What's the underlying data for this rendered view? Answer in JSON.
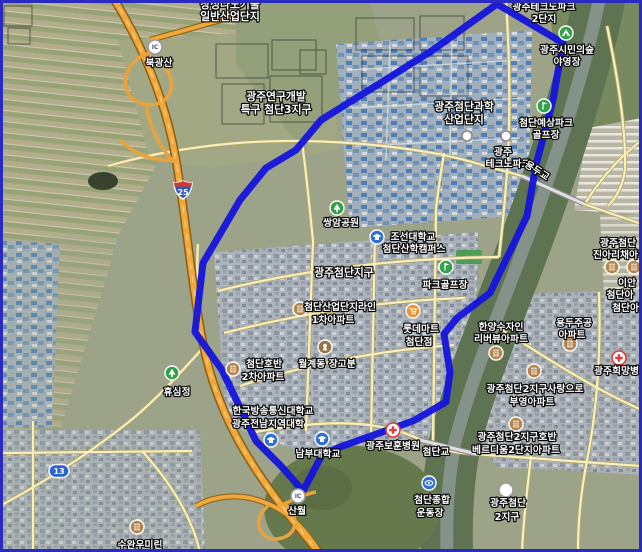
{
  "map": {
    "type": "satellite-map-with-district-boundary",
    "colors": {
      "boundary": "#1414dd",
      "frame": "#2a2ac0",
      "expressway": "#f0a73c",
      "minor_road": "#f6efc6",
      "river": "#5d7351",
      "marker_green": "#33a04a",
      "marker_blue": "#2f6fd6",
      "marker_brown": "#b5854e",
      "marker_orange": "#f09433",
      "hospital_red": "#e23b3b"
    },
    "labels": {
      "nano1": "장성나노기술",
      "nano2": "일반산업단지",
      "rnd1": "광주연구개발",
      "rnd2": "특구 첨단3지구",
      "ic_badge": "IC",
      "ic_bukgwangsan": "북광산",
      "route25": "25",
      "route13": "13",
      "tp1": "광주테크노파크",
      "tp2": "2단지",
      "forest1": "광주시민의숲",
      "forest2": "야영장",
      "sci1": "광주첨단과학",
      "sci2": "산업단지",
      "pgolf_n1": "첨단예상파크",
      "pgolf_n2": "골프장",
      "gtp1": "광주",
      "gtp2": "테크노파크",
      "yongdu_bridge": "용두교",
      "ssangam": "쌍암공원",
      "chosun1": "조선대학교",
      "chosun2": "첨단산학캠퍼스",
      "district": "광주첨단지구",
      "pgolf": "파크골프장",
      "line_apt1": "첨단산업단지라인",
      "line_apt2": "1차아파트",
      "lotte1": "롯데마트",
      "lotte2": "첨단점",
      "tomb": "월계동 장고분",
      "hoban1": "첨단호반",
      "hoban2": "2차아파트",
      "hyusim": "휴심정",
      "knou1": "한국방송통신대학교",
      "knou2": "광주전남지역대학",
      "nambu": "남부대학교",
      "bohun": "광주보훈병원",
      "bridge_cheomdan": "첨단교",
      "stad1": "첨단종합",
      "stad2": "운동장",
      "ic_sanwol": "산월",
      "suwan": "수완우미린",
      "hanyang1": "한양수자인",
      "hanyang2": "리버뷰아파트",
      "yongdu1": "용두주공",
      "yongdu2": "아파트",
      "apt_ne": "첨단아파트",
      "hope": "광주희망병원",
      "buyeong1": "광주첨단2지구사랑으로",
      "buyeong2": "부영아파트",
      "verd1": "광주첨단2지구호반",
      "verd2": "베르디움2단지아파트",
      "cd2_1": "광주첨단",
      "cd2_2": "2지구",
      "jina1": "광주첨단",
      "jina2": "진아리채아파트",
      "iaan1": "이안",
      "iaan2": "첨단아"
    }
  }
}
